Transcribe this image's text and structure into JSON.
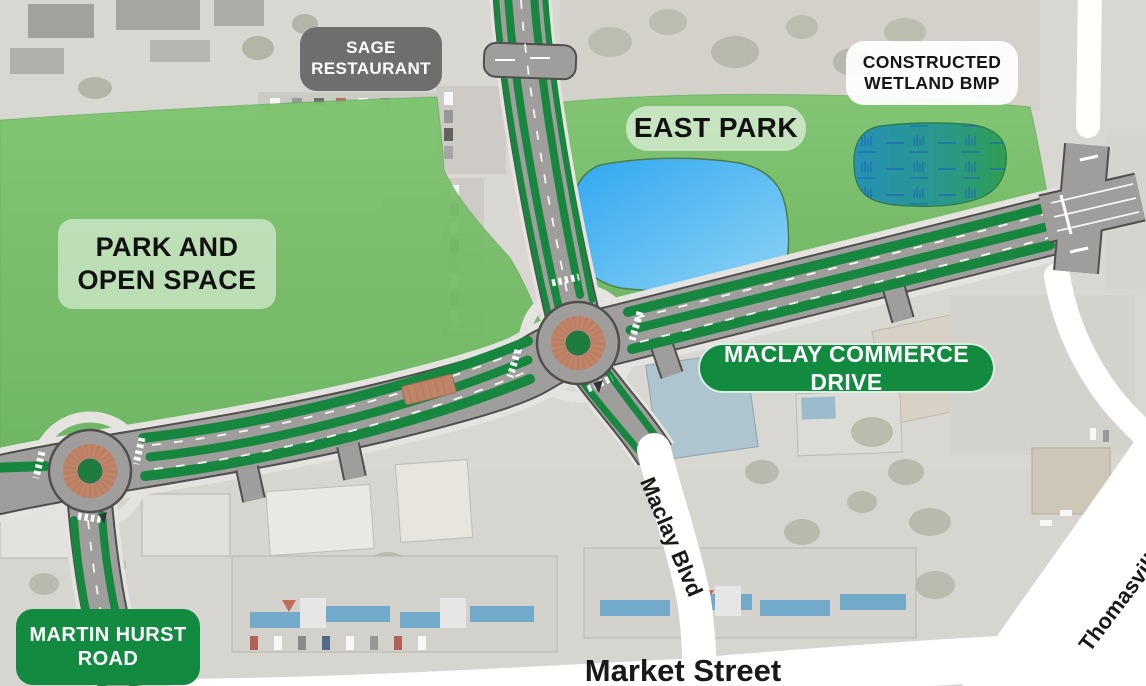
{
  "title": "Maclay Commerce Drive / East Park site plan over aerial photo",
  "colors": {
    "park_green": "#7cc46d",
    "park_green_dark": "#68b45c",
    "median_green": "#17873f",
    "sign_green": "#128a40",
    "sign_gray": "#6e6e6e",
    "road_gray": "#a09e9c",
    "road_casing": "#4f4f4d",
    "sidewalk": "#e4e3e0",
    "pond_blue": "#2fa7ef",
    "pond_blue_light": "#8ed3f6",
    "wetland_teal": "#2691b5",
    "wetland_green": "#2f9e52",
    "marsh_symbol": "#1a6cae",
    "brick": "#c08468",
    "existing_road_white": "#ffffff"
  },
  "labels": {
    "sage_restaurant": {
      "line1": "SAGE",
      "line2": "RESTAURANT"
    },
    "constructed_wetland": {
      "line1": "CONSTRUCTED",
      "line2": "WETLAND BMP"
    },
    "east_park": {
      "text": "EAST PARK"
    },
    "park_open_space": {
      "line1": "PARK AND",
      "line2": "OPEN SPACE"
    },
    "maclay_commerce_drive": {
      "text": "MACLAY COMMERCE DRIVE"
    },
    "martin_hurst_road": {
      "line1": "MARTIN HURST",
      "line2": "ROAD"
    },
    "maclay_blvd": {
      "text": "Maclay Blvd"
    },
    "market_street": {
      "text": "Market Street"
    },
    "thomasville_road": {
      "text": "Thomasville Rd"
    }
  }
}
